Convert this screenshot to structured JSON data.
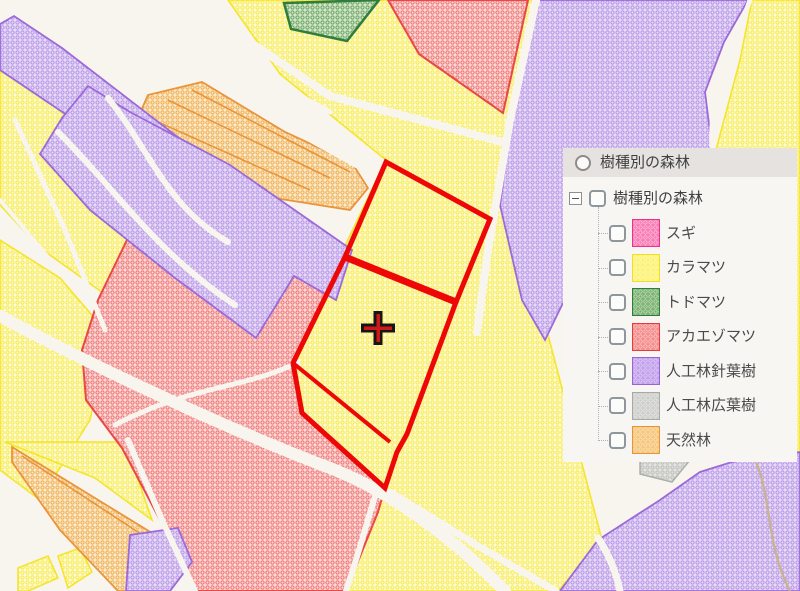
{
  "app": {
    "title": "樹種別の森林マップ"
  },
  "panel": {
    "radio_layer": {
      "label": "樹種別の森林",
      "selected": false
    },
    "tree_root": {
      "label": "樹種別の森林",
      "checked": false,
      "expanded": true
    },
    "items": [
      {
        "id": "sugi",
        "label": "スギ",
        "checked": false,
        "base": "#fa7eb5",
        "dot": "#f23d96",
        "border": "#ee2f8c"
      },
      {
        "id": "karamatsu",
        "label": "カラマツ",
        "checked": false,
        "base": "#fcf376",
        "dot": "#f8e838",
        "border": "#f0df25"
      },
      {
        "id": "todomatsu",
        "label": "トドマツ",
        "checked": false,
        "base": "#7fb575",
        "dot": "#4c9d4e",
        "border": "#2e7d3c"
      },
      {
        "id": "akaezomatsu",
        "label": "アカエゾマツ",
        "checked": false,
        "base": "#f58f8f",
        "dot": "#ee5a5a",
        "border": "#e83c3c"
      },
      {
        "id": "jinko-shinyoju",
        "label": "人工林針葉樹",
        "checked": false,
        "base": "#c3a2ec",
        "dot": "#a678e2",
        "border": "#9a63d8"
      },
      {
        "id": "jinko-koyoju",
        "label": "人工林広葉樹",
        "checked": false,
        "base": "#cfcfcc",
        "dot": "#b4b4b0",
        "border": "#a7aaa7"
      },
      {
        "id": "tennenrin",
        "label": "天然林",
        "checked": false,
        "base": "#f6c77d",
        "dot": "#efa23d",
        "border": "#e8923a"
      }
    ]
  },
  "map": {
    "background": "#f8f5ef",
    "selection_color": "#ee0707",
    "crosshair": {
      "x": 378,
      "y": 328
    },
    "palette": {
      "karamatsu": {
        "base": "#fdfad6",
        "dot": "#f7ea42",
        "stroke": "#f4e52e"
      },
      "akaezomatsu": {
        "base": "#f9d9d5",
        "dot": "#f07070",
        "stroke": "#e84848"
      },
      "jinko_shinyoju": {
        "base": "#e6daf6",
        "dot": "#b492e6",
        "stroke": "#9c6ad8"
      },
      "tennenrin": {
        "base": "#faeacc",
        "dot": "#f0aa48",
        "stroke": "#e9953c"
      },
      "todomatsu": {
        "base": "#d4e6c9",
        "dot": "#66a25e",
        "stroke": "#2e7d3c"
      },
      "jinko_koyoju": {
        "base": "#e3e3df",
        "dot": "#bcbcb8",
        "stroke": "#aab0ad"
      }
    }
  }
}
